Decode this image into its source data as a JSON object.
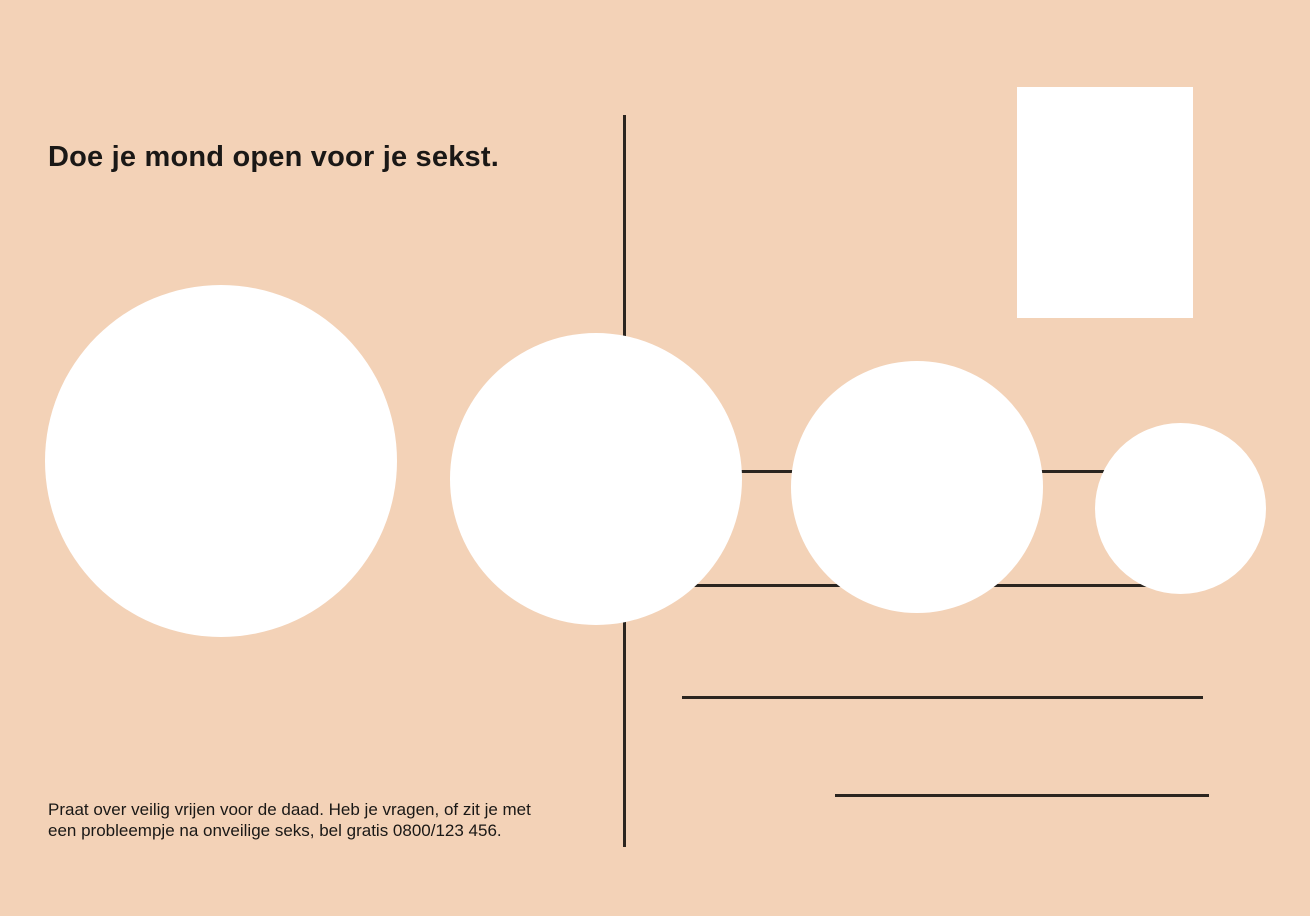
{
  "postcard": {
    "headline": "Doe je mond open voor je sekst.",
    "footer": {
      "line1": "Praat over veilig vrijen voor de daad. Heb je vragen, of zit je met",
      "line2": "een probleempje na onveilige seks, bel gratis 0800/123 456.",
      "phone": "0800/123 456"
    }
  },
  "colors": {
    "background": "#f3d2b7",
    "ink": "#2b251f",
    "text": "#1a1816",
    "shape_fill": "#ffffff"
  }
}
